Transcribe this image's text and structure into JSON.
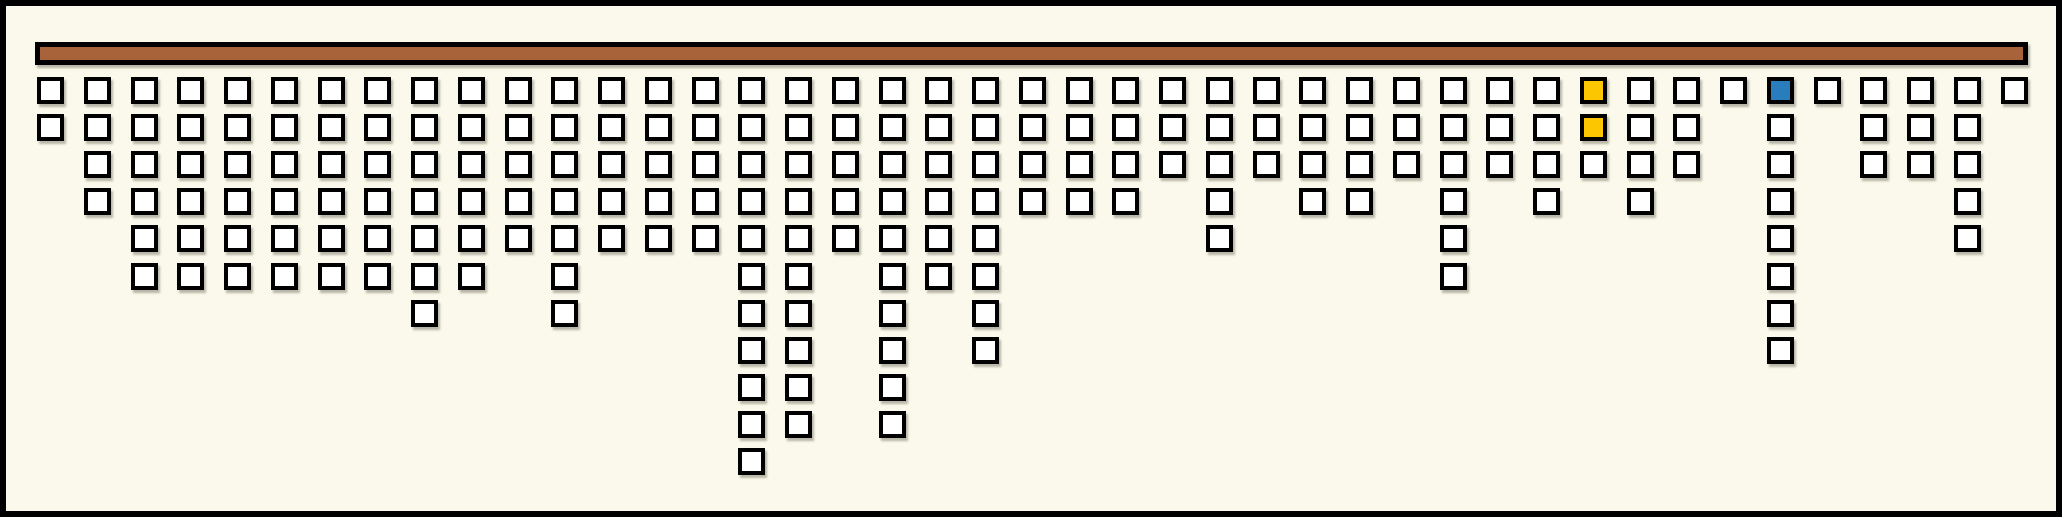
{
  "figure": {
    "background": "#FAF9EB",
    "frame_color": "#000000",
    "bar": {
      "fill": "#A8633B",
      "border": "#000000"
    }
  },
  "chart_data": {
    "type": "icon-array",
    "layout": "columns of square icons hanging downward from a horizontal bar",
    "num_columns": 43,
    "column_counts": [
      2,
      4,
      6,
      6,
      6,
      6,
      6,
      6,
      7,
      6,
      5,
      7,
      5,
      5,
      5,
      11,
      10,
      5,
      10,
      6,
      8,
      4,
      4,
      4,
      3,
      5,
      3,
      4,
      4,
      3,
      6,
      3,
      4,
      3,
      4,
      3,
      1,
      8,
      1,
      3,
      3,
      5,
      1
    ],
    "max_column_count": 11,
    "total_cells": 211,
    "cell_colors": {
      "default": "#FFFFFF",
      "yellow": "#FCC600",
      "blue": "#2A7DBD"
    },
    "highlighted_cells": [
      {
        "column": 34,
        "row": 1,
        "color": "yellow"
      },
      {
        "column": 34,
        "row": 2,
        "color": "yellow"
      },
      {
        "column": 38,
        "row": 1,
        "color": "blue"
      }
    ],
    "grid": false,
    "axes_visible": false,
    "text_labels": []
  }
}
